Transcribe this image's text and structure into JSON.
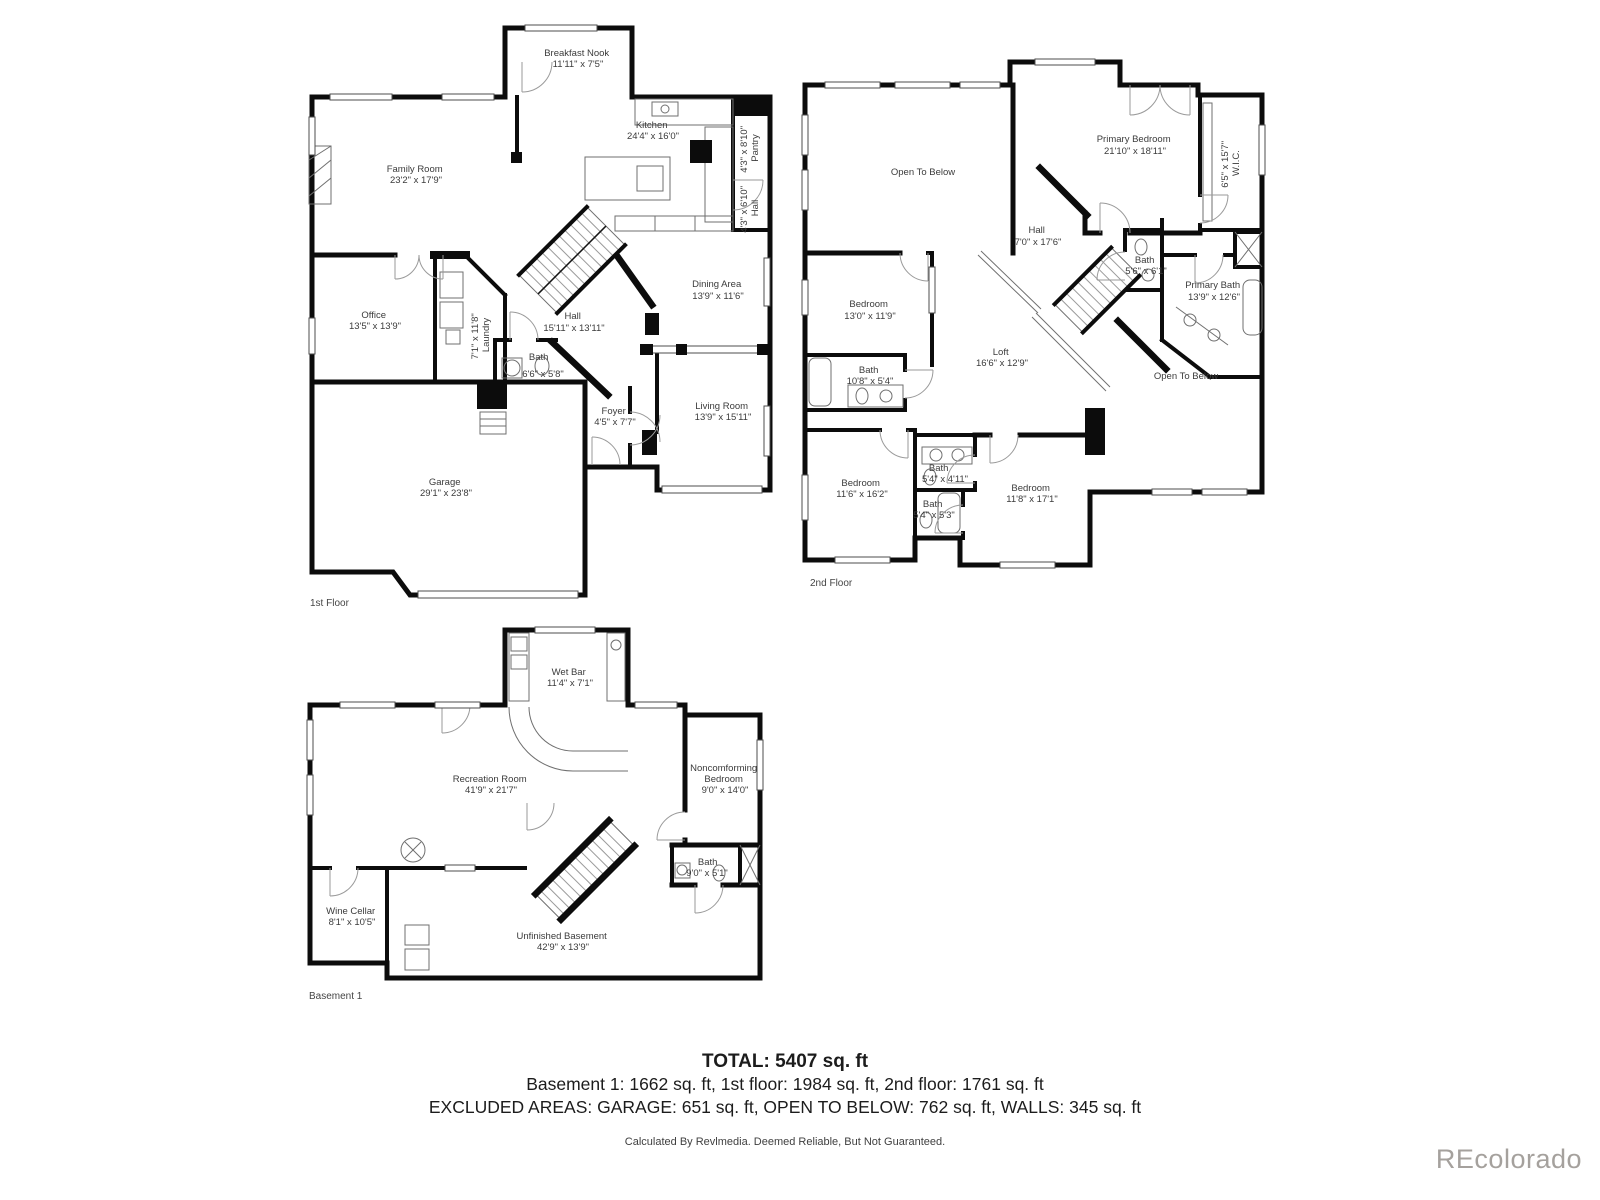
{
  "floors": {
    "first": {
      "label": "1st Floor",
      "rooms": {
        "breakfast_nook": {
          "name": "Breakfast Nook",
          "dims": "11'11\" x 7'5\""
        },
        "kitchen": {
          "name": "Kitchen",
          "dims": "24'4\" x 16'0\""
        },
        "family_room": {
          "name": "Family Room",
          "dims": "23'2\" x 17'9\""
        },
        "pantry": {
          "name": "Pantry",
          "dims": "4'3\" x 8'10\""
        },
        "hall_side": {
          "name": "Hall",
          "dims": "4'3\" x 6'10\""
        },
        "office": {
          "name": "Office",
          "dims": "13'5\" x 13'9\""
        },
        "laundry": {
          "name": "Laundry",
          "dims": "7'1\" x 11'8\""
        },
        "hall": {
          "name": "Hall",
          "dims": "15'11\" x 13'11\""
        },
        "dining_area": {
          "name": "Dining Area",
          "dims": "13'9\" x 11'6\""
        },
        "bath": {
          "name": "Bath",
          "dims": "6'6\" x 5'8\""
        },
        "foyer": {
          "name": "Foyer",
          "dims": "4'5\" x 7'7\""
        },
        "living_room": {
          "name": "Living Room",
          "dims": "13'9\" x 15'11\""
        },
        "garage": {
          "name": "Garage",
          "dims": "29'1\" x 23'8\""
        }
      }
    },
    "second": {
      "label": "2nd Floor",
      "rooms": {
        "open_to_below_left": {
          "name": "Open To Below"
        },
        "primary_bedroom": {
          "name": "Primary Bedroom",
          "dims": "21'10\" x 18'11\""
        },
        "wic": {
          "name": "W.I.C.",
          "dims": "6'5\" x 15'7\""
        },
        "hall": {
          "name": "Hall",
          "dims": "7'0\" x 17'6\""
        },
        "hall_bath": {
          "name": "Bath",
          "dims": "5'6\" x 6'1\""
        },
        "primary_bath": {
          "name": "Primary Bath",
          "dims": "13'9\" x 12'6\""
        },
        "bedroom_left": {
          "name": "Bedroom",
          "dims": "13'0\" x 11'9\""
        },
        "bath_left": {
          "name": "Bath",
          "dims": "10'8\" x 5'4\""
        },
        "loft": {
          "name": "Loft",
          "dims": "16'6\" x 12'9\""
        },
        "open_to_below_right": {
          "name": "Open To Below"
        },
        "bedroom_sw": {
          "name": "Bedroom",
          "dims": "11'6\" x 16'2\""
        },
        "bath_mid_upper": {
          "name": "Bath",
          "dims": "5'4\" x 4'11\""
        },
        "bath_mid_lower": {
          "name": "Bath",
          "dims": "5'4\" x 5'3\""
        },
        "bedroom_se": {
          "name": "Bedroom",
          "dims": "11'8\" x 17'1\""
        }
      }
    },
    "basement": {
      "label": "Basement 1",
      "rooms": {
        "wet_bar": {
          "name": "Wet Bar",
          "dims": "11'4\" x 7'1\""
        },
        "recreation_room": {
          "name": "Recreation Room",
          "dims": "41'9\" x 21'7\""
        },
        "noncomforming_bedroom": {
          "name": "Noncomforming",
          "name2": "Bedroom",
          "dims": "9'0\" x 14'0\""
        },
        "bath": {
          "name": "Bath",
          "dims": "9'0\" x 5'1\""
        },
        "wine_cellar": {
          "name": "Wine Cellar",
          "dims": "8'1\" x 10'5\""
        },
        "unfinished_basement": {
          "name": "Unfinished Basement",
          "dims": "42'9\" x 13'9\""
        }
      }
    }
  },
  "summary": {
    "total": "TOTAL: 5407 sq. ft",
    "floor_totals": "Basement 1: 1662 sq. ft, 1st floor: 1984 sq. ft, 2nd floor: 1761 sq. ft",
    "excluded": "EXCLUDED AREAS: GARAGE: 651 sq. ft, OPEN TO BELOW: 762 sq. ft, WALLS: 345 sq. ft",
    "disclaimer": "Calculated By Revlmedia. Deemed Reliable, But Not Guaranteed.",
    "watermark": "REcolorado"
  },
  "colors": {
    "wall": "#0c0c0c",
    "thin_line": "#6f6f6f",
    "text": "#3b3b3b",
    "watermark": "#a5a19d"
  }
}
